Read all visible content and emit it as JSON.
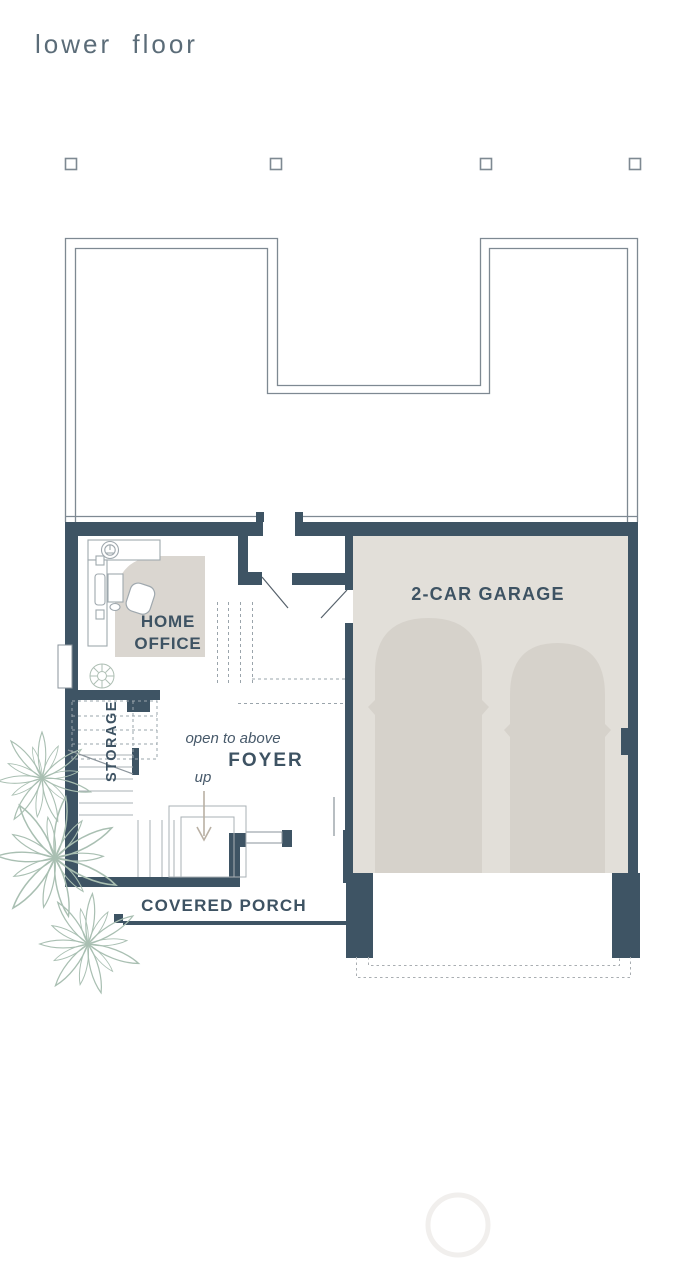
{
  "title": "lower floor",
  "rooms": {
    "home_office": {
      "line1": "HOME",
      "line2": "OFFICE"
    },
    "garage": {
      "label": "2-CAR GARAGE"
    },
    "storage": {
      "label": "STORAGE"
    },
    "foyer": {
      "label": "FOYER",
      "note": "open to above",
      "stair_direction": "up"
    },
    "porch": {
      "label": "COVERED PORCH"
    }
  },
  "colors": {
    "wall": "#3e5464",
    "room_text": "#3e5363",
    "title_text": "#5b6c78",
    "outline": "#7e8992",
    "garage_floor": "#e2dfd9",
    "car": "#d6d2cb",
    "rug": "#dad6d0",
    "plant": "#a9bfb2",
    "arrow": "#b9b0a4",
    "background": "#ffffff"
  }
}
